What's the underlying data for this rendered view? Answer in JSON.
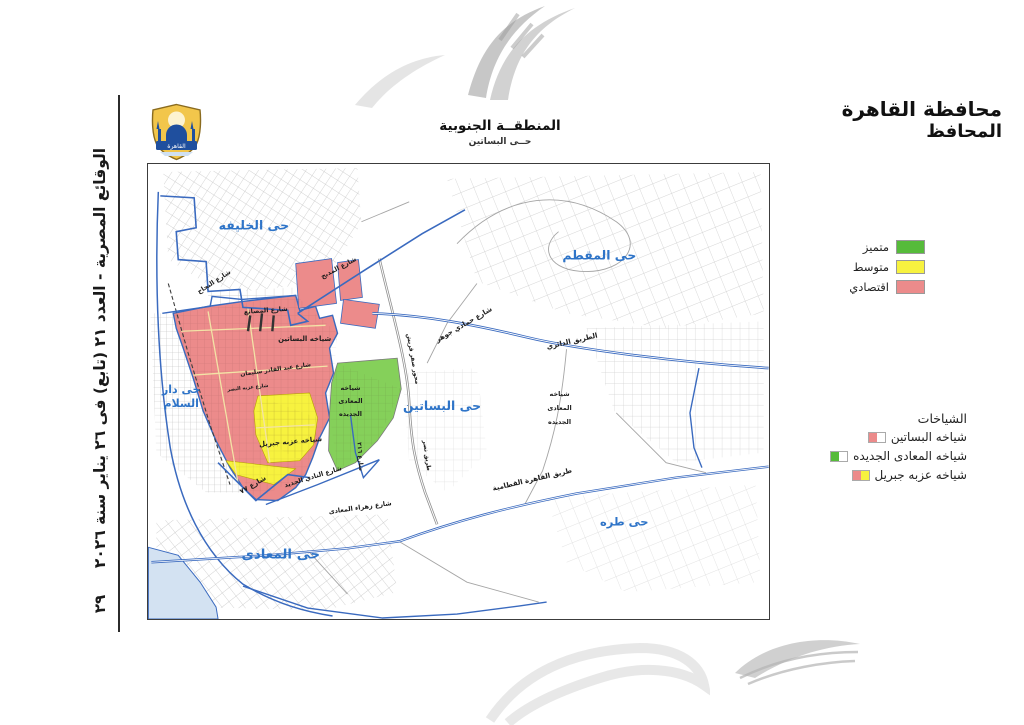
{
  "page": {
    "margin_text": "الوقائع المصرية - العدد ٢١ (تابع) فى ٢٦ يناير سنة ٢٠٢٦",
    "page_number": "٢٩"
  },
  "header": {
    "title": "محافظة القاهرة",
    "subtitle": "المحافظ"
  },
  "map": {
    "title": "المنطقــة الجنوبية",
    "subtitle": "حــى البساتين",
    "logo_text": "القاهرة",
    "districts": {
      "khalifa": "حى الخليفه",
      "mokattam": "حى المقطم",
      "dar_elsalam_l1": "حى دار",
      "dar_elsalam_l2": "السلام",
      "basatin": "حى البساتين",
      "maadi": "حى المعادى",
      "tora": "حى طره"
    },
    "sheyakhat": {
      "basatin": "شياخه البساتين",
      "ezbet_gebril": "شياخه عزبه جبريل",
      "maadi_gadida_l1": "شياخه",
      "maadi_gadida_l2": "المعادى",
      "maadi_gadida_l3": "الجديده"
    },
    "streets": {
      "najah": "شارع النجاح",
      "madbah": "شارع المدبح",
      "masanea": "شارع المصانع",
      "abdelkader": "شارع عبد القادر سليمان",
      "ezbet_elnasr": "شارع عزبه النصر",
      "hamadi_gohar": "شارع حمادي جوهر",
      "ring_road": "الطريق الدائري",
      "mehwar": "محور صقر قريش",
      "tariq_nasr": "طريق نصر",
      "st216": "شارع ٢١٦",
      "st77": "شارع ٧٧",
      "nadi_gadid": "شارع النادي الجديد",
      "zahraa_maadi": "شارع زهراء المعادى",
      "katameya": "طريق القاهرة القطامية"
    }
  },
  "colors": {
    "premium": "#56bb3a",
    "premium_area": "#85d05a",
    "medium": "#f7f23f",
    "economic": "#ec8b8b",
    "district_label": "#2e74c8",
    "road_blue": "#3a6abf",
    "water": "#d3e2f2",
    "white": "#ffffff"
  },
  "legend_levels": {
    "items": [
      {
        "label": "متميز"
      },
      {
        "label": "متوسط"
      },
      {
        "label": "اقتصادي"
      }
    ]
  },
  "legend_sheyakhat": {
    "title": "الشياخات",
    "items": [
      {
        "label": "شياخه البساتين",
        "left": "#ec8b8b",
        "right": "#ffffff"
      },
      {
        "label": "شياخه المعادى الجديده",
        "left": "#56bb3a",
        "right": "#ffffff"
      },
      {
        "label": "شياخه عزبه جبريل",
        "left": "#ec8b8b",
        "right": "#f7f23f"
      }
    ]
  }
}
